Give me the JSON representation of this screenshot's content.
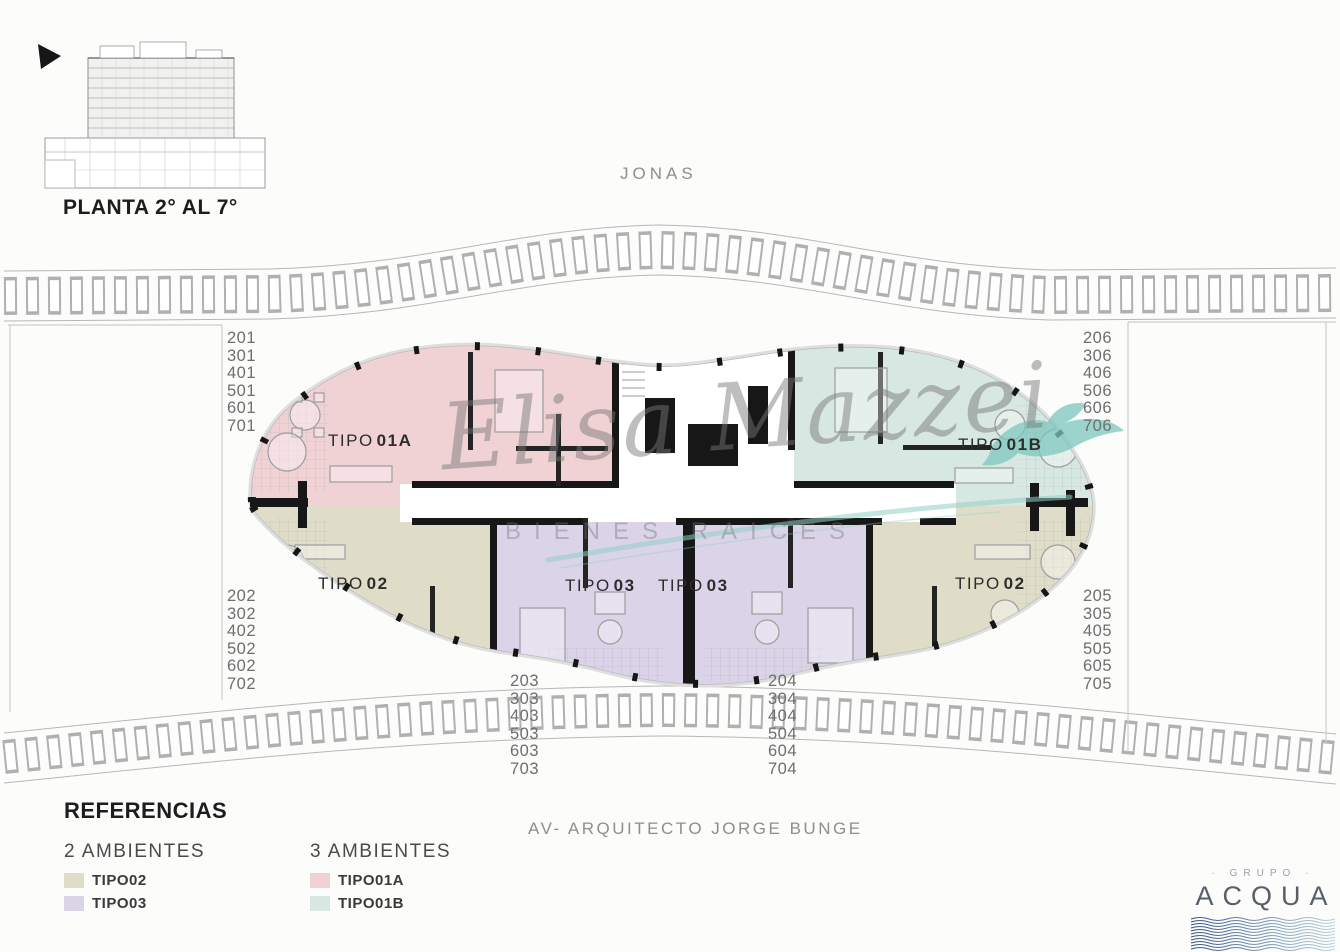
{
  "header": {
    "plan_label": "PLANTA 2° AL 7°"
  },
  "streets": {
    "top": "JONAS",
    "bottom": "AV- ARQUITECTO JORGE BUNGE"
  },
  "watermark": {
    "script": "Elisa Mazzei",
    "subtitle": "BIENES RAICES"
  },
  "plan_units": [
    {
      "id": "tipo01a",
      "word": "TIPO",
      "code": "01A"
    },
    {
      "id": "tipo01b",
      "word": "TIPO",
      "code": "01B"
    },
    {
      "id": "tipo02-left",
      "word": "TIPO",
      "code": "02"
    },
    {
      "id": "tipo02-right",
      "word": "TIPO",
      "code": "02"
    },
    {
      "id": "tipo03-left",
      "word": "TIPO",
      "code": "03"
    },
    {
      "id": "tipo03-right",
      "word": "TIPO",
      "code": "03"
    }
  ],
  "units": {
    "left_top": [
      "201",
      "301",
      "401",
      "501",
      "601",
      "701"
    ],
    "left_bottom": [
      "202",
      "302",
      "402",
      "502",
      "602",
      "702"
    ],
    "right_top": [
      "206",
      "306",
      "406",
      "506",
      "606",
      "706"
    ],
    "right_bottom": [
      "205",
      "305",
      "405",
      "505",
      "605",
      "705"
    ],
    "bottom_left": [
      "203",
      "303",
      "403",
      "503",
      "603",
      "703"
    ],
    "bottom_right": [
      "204",
      "304",
      "404",
      "504",
      "604",
      "704"
    ]
  },
  "legend": {
    "title": "REFERENCIAS",
    "groups": [
      {
        "heading": "2 AMBIENTES",
        "items": [
          {
            "label": "TIPO02",
            "color": "#dfddc8"
          },
          {
            "label": "TIPO03",
            "color": "#dbd3e8"
          }
        ]
      },
      {
        "heading": "3 AMBIENTES",
        "items": [
          {
            "label": "TIPO01A",
            "color": "#f0d2d5"
          },
          {
            "label": "TIPO01B",
            "color": "#d7e7e2"
          }
        ]
      }
    ]
  },
  "logo": {
    "top": "· GRUPO ·",
    "name": "ACQUA"
  },
  "colors": {
    "tipo01a": "#f0d2d5",
    "tipo01b": "#d7e7e2",
    "tipo02": "#dfddc8",
    "tipo03": "#dbd3e8",
    "watermark_teal": "#8fcfc5",
    "logo_blue": "#53749c"
  }
}
